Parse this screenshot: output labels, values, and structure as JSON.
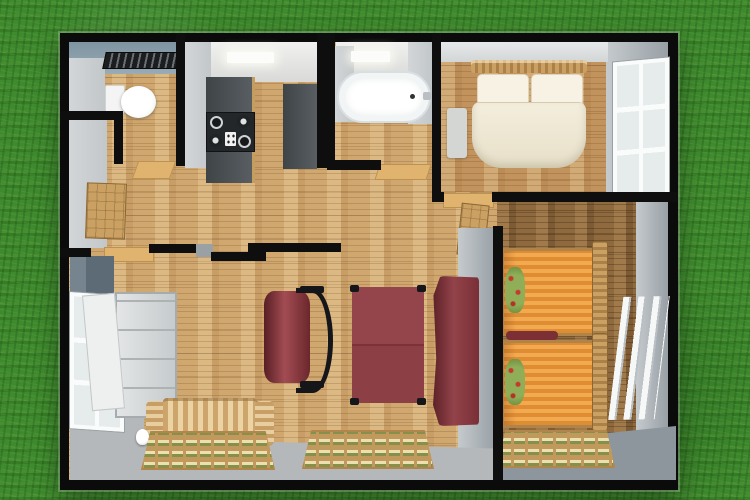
{
  "scene": {
    "label": "3D top-view floor plan of a small house on a grass lawn"
  },
  "colors": {
    "grass": "#3e8a2d",
    "exterior_wall": "#0b0b0b",
    "floor_wood_light": "#d0a76e",
    "floor_wood_mid": "#c2935c",
    "floor_wood_dark": "#8f6a3e",
    "wall_face_light": "#cdd1d3",
    "wall_face_medium": "#9aa2a8",
    "wall_face_blue": "#7e94a1",
    "wall_face_dark": "#5d6b76",
    "kitchen_counter": "#474c50",
    "furniture_maroon": "#82343b",
    "bed_cover_orange": "#e8963c",
    "bedding_cream": "#f2ecda",
    "sofa_tan": "#d9b987",
    "rug_base": "#c2995c",
    "rug_olive": "#85914b",
    "rug_cream": "#ecdfb0",
    "walkway_gray": "#b5b8ba",
    "bathtub_white": "#ffffff",
    "threshold_tan": "#e0b46f"
  },
  "rooms": {
    "wc": {
      "label": "toilet room",
      "items": [
        "ceiling-vent",
        "toilet"
      ]
    },
    "kitchen": {
      "label": "kitchen",
      "items": [
        "counter",
        "stove",
        "tall-cabinet",
        "ceiling-light"
      ]
    },
    "bathroom": {
      "label": "bathroom",
      "items": [
        "bathtub",
        "ceiling-light"
      ]
    },
    "bedroom_main": {
      "label": "main bedroom with double bed",
      "items": [
        "double-bed",
        "pillows",
        "nightstand",
        "window"
      ]
    },
    "bedroom_twin": {
      "label": "twin bedroom with two single beds",
      "items": [
        "single-bed",
        "single-bed",
        "rug",
        "window"
      ]
    },
    "living": {
      "label": "living room",
      "items": [
        "wardrobe",
        "window",
        "armchair",
        "table",
        "sideboard",
        "sofa",
        "kettle",
        "rug",
        "rug"
      ]
    },
    "hall": {
      "label": "entry hall",
      "items": [
        "entry-door",
        "threshold"
      ]
    }
  },
  "furniture": {
    "toilet": "toilet",
    "bathtub": "bathtub",
    "double_bed": "double bed",
    "single_bed_a": "single bed",
    "single_bed_b": "single bed",
    "sofa": "striped sofa",
    "table": "table",
    "armchair": "armchair",
    "sideboard": "sideboard",
    "wardrobe": "wardrobe",
    "entry_door": "open entry door"
  }
}
